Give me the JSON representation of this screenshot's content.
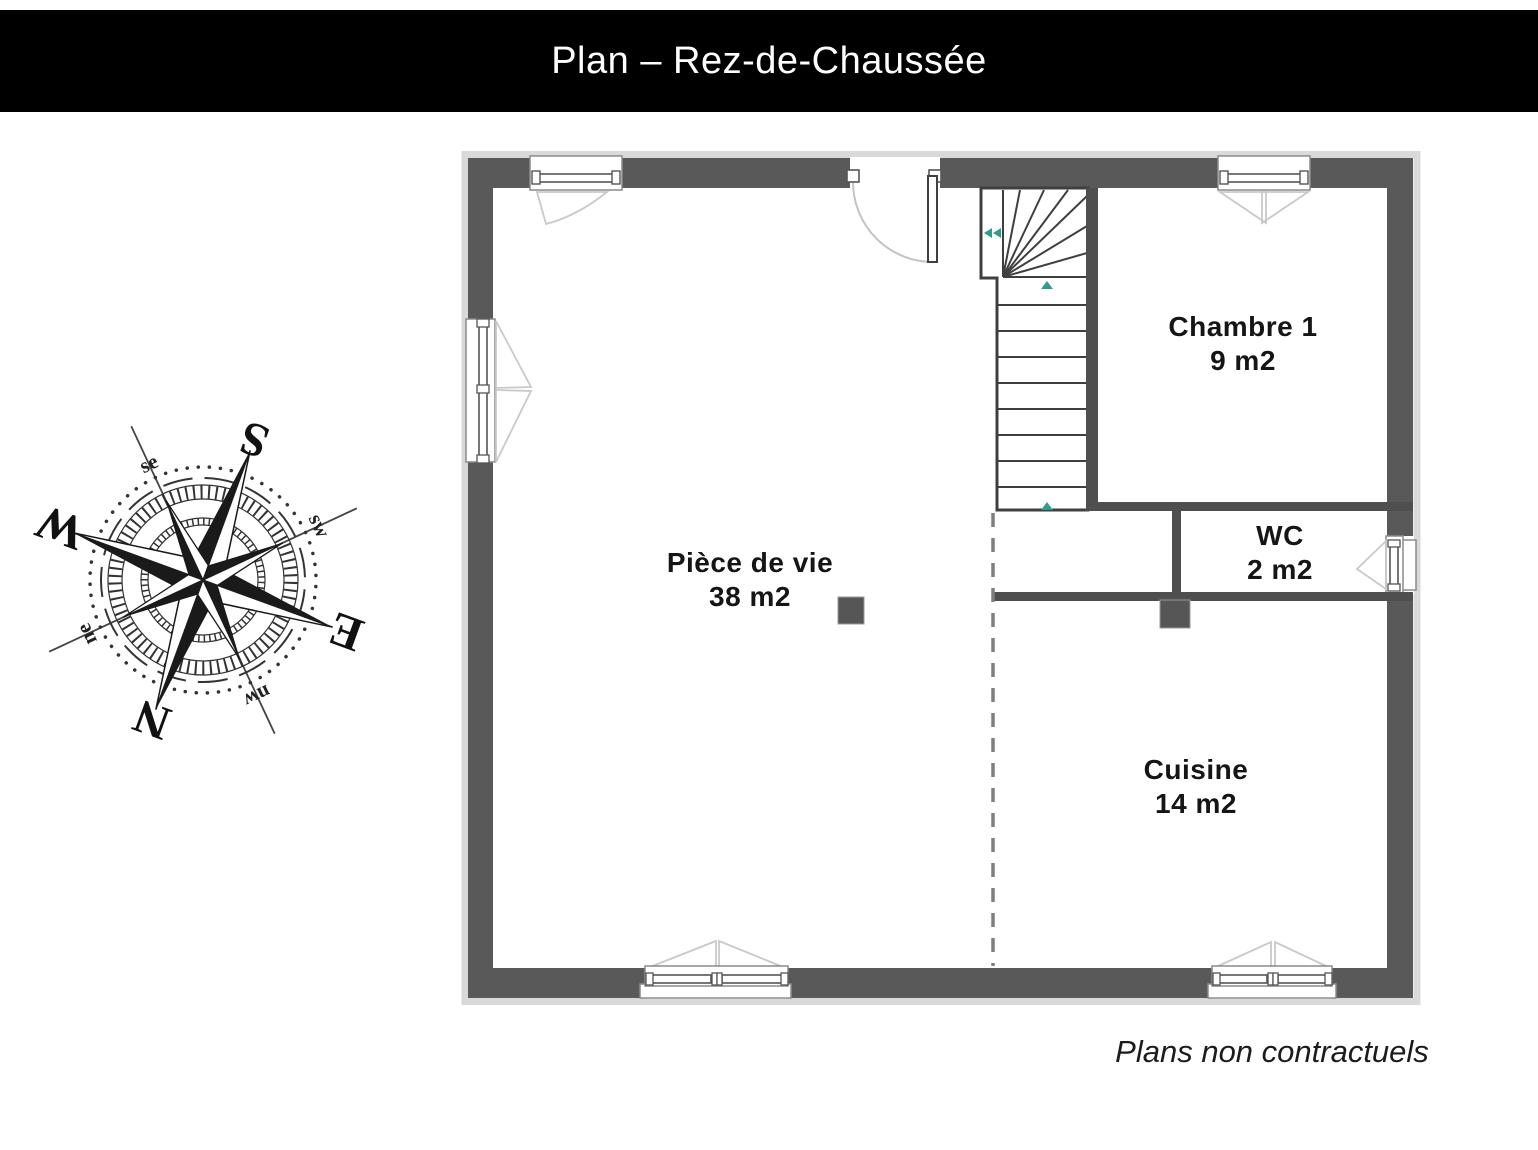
{
  "header": {
    "title": "Plan – Rez-de-Chaussée"
  },
  "rooms": [
    {
      "id": "piece-de-vie",
      "label": "Pièce de vie",
      "area": "38 m2"
    },
    {
      "id": "chambre-1",
      "label": "Chambre 1",
      "area": "9 m2"
    },
    {
      "id": "wc",
      "label": "WC",
      "area": "2 m2"
    },
    {
      "id": "cuisine",
      "label": "Cuisine",
      "area": "14 m2"
    }
  ],
  "compass": {
    "cardinals": {
      "n": "N",
      "s": "S",
      "e": "E",
      "w": "W"
    },
    "intercardinals": {
      "ne": "ne",
      "se": "se",
      "sw": "sw",
      "nw": "nw"
    }
  },
  "footer": {
    "disclaimer": "Plans non contractuels"
  },
  "colors": {
    "title_bar_bg": "#000000",
    "title_text": "#ffffff",
    "exterior_wall": "#595959",
    "partition_wall": "#4f4f4f",
    "stair_outline": "#3f3f3f",
    "outer_frame": "#d9d9d9",
    "swing_symbol": "#c9c9c9",
    "direction_arrow": "#2e9d8a",
    "label_text": "#151515"
  }
}
